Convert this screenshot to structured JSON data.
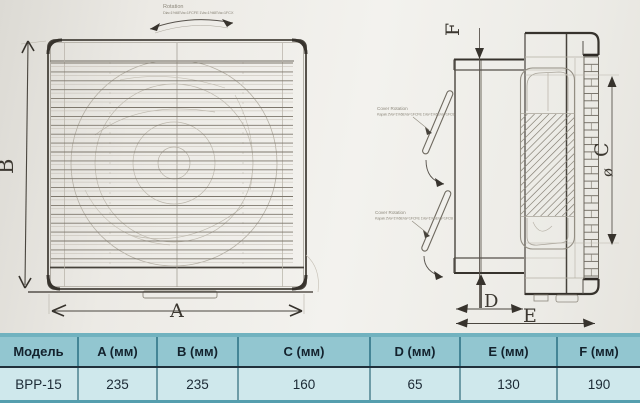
{
  "drawing": {
    "dimension_labels": {
      "A": "A",
      "B": "B",
      "C": "C",
      "D": "D",
      "E": "E",
      "F": "F",
      "diameter": "ø"
    },
    "annotations": {
      "rotation_title": "Rotation",
      "rotation_detail": "Dia=1%6EVa=1FCFE 1Va=1%6EVa=1FCX",
      "cover_rotation_title": "Cover Rotation",
      "cover_rotation_detail": "Kapak 2Va=1%6EVa=1FCFE 1Va=1%6EVa=1FCB"
    }
  },
  "table": {
    "columns": [
      "Модель",
      "A (мм)",
      "B (мм)",
      "C (мм)",
      "D (мм)",
      "E (мм)",
      "F (мм)"
    ],
    "rows": [
      [
        "BPP-15",
        "235",
        "235",
        "160",
        "65",
        "130",
        "190"
      ]
    ]
  },
  "colors": {
    "table_header_bg": "#92c6d0",
    "table_row_bg": "#cfe8ec",
    "table_top_border": "#71b2bf",
    "table_divider": "#20303b",
    "pencil_dark": "#3f3b35",
    "pencil_faint": "#b5b0a5"
  }
}
